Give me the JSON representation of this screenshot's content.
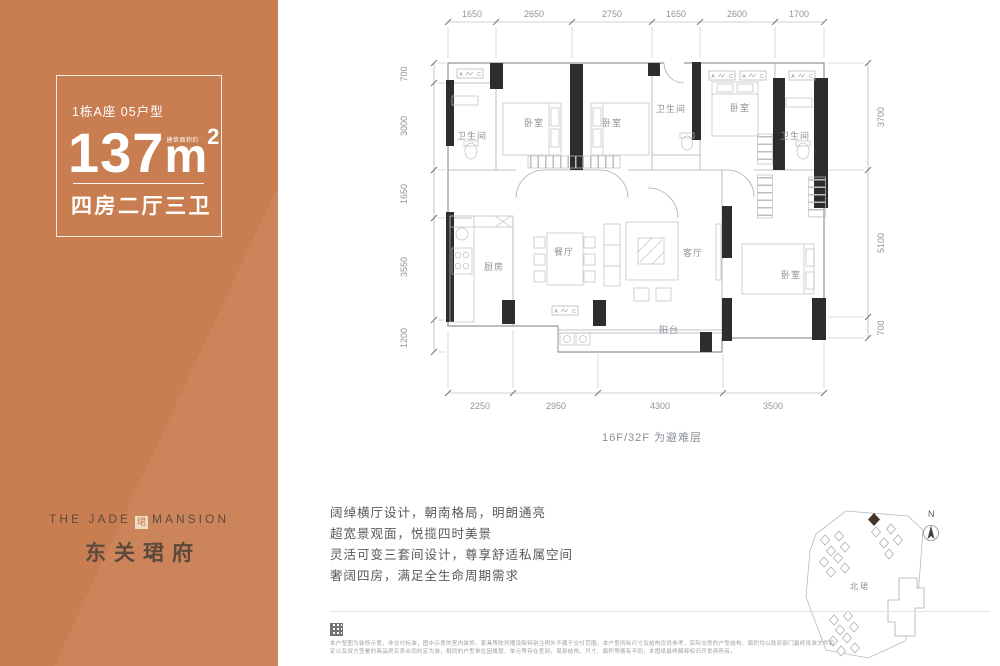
{
  "panel": {
    "unit_label": "1栋A座 05户型",
    "area_value": "137",
    "area_unit": "m",
    "area_exp": "2",
    "area_note": "建筑面积约",
    "rooms_summary": "四房二厅三卫",
    "brand_line_left": "THE JADE",
    "brand_line_right": "MANSION",
    "brand_seal": "珺",
    "brand_cn": "东关珺府"
  },
  "plan": {
    "dims_top": [
      "1650",
      "2650",
      "2750",
      "1650",
      "2600",
      "1700"
    ],
    "dims_bottom": [
      "2250",
      "2950",
      "4300",
      "3500"
    ],
    "dims_left": [
      "700",
      "3000",
      "1650",
      "3550",
      "1200"
    ],
    "dims_right": [
      "3700",
      "5100",
      "700"
    ],
    "room_labels": [
      "卫生间",
      "卧室",
      "卧室",
      "卫生间",
      "卧室",
      "卫生间",
      "厨房",
      "餐厅",
      "客厅",
      "卧室",
      "阳台"
    ],
    "ac_left": "A",
    "ac_right": "C",
    "floor_note": "16F/32F 为避难层"
  },
  "features": [
    "阔绰横厅设计，朝南格局，明朗通亮",
    "超宽景观面，悦揽四时美景",
    "灵活可变三套间设计，尊享舒适私属空间",
    "奢阔四房，满足全生命周期需求"
  ],
  "sitemap": {
    "north_label": "N",
    "estate_label": "北珺"
  },
  "disclaimer": {
    "line1": "本户型图为装修示意，非交付标准，图中示意的室内装饰、家具等陈列摆设除特别注明外不属于交付范围，本户型所标尺寸及结构仅供参考，实际交房的户型结构、面积均以政府部门最终批准文件和",
    "line2": "定以及双方签署的商品房买卖合同约定为准，相同的户型单位因楼层、单元等存在差别，局部结构、尺寸、面积等略有不同，本图纸最终解释权归开发商所有。"
  },
  "colors": {
    "accent_orange": "#c97e52",
    "logo_brown": "#5d4a3c",
    "wall_black": "#2d2d2d"
  }
}
